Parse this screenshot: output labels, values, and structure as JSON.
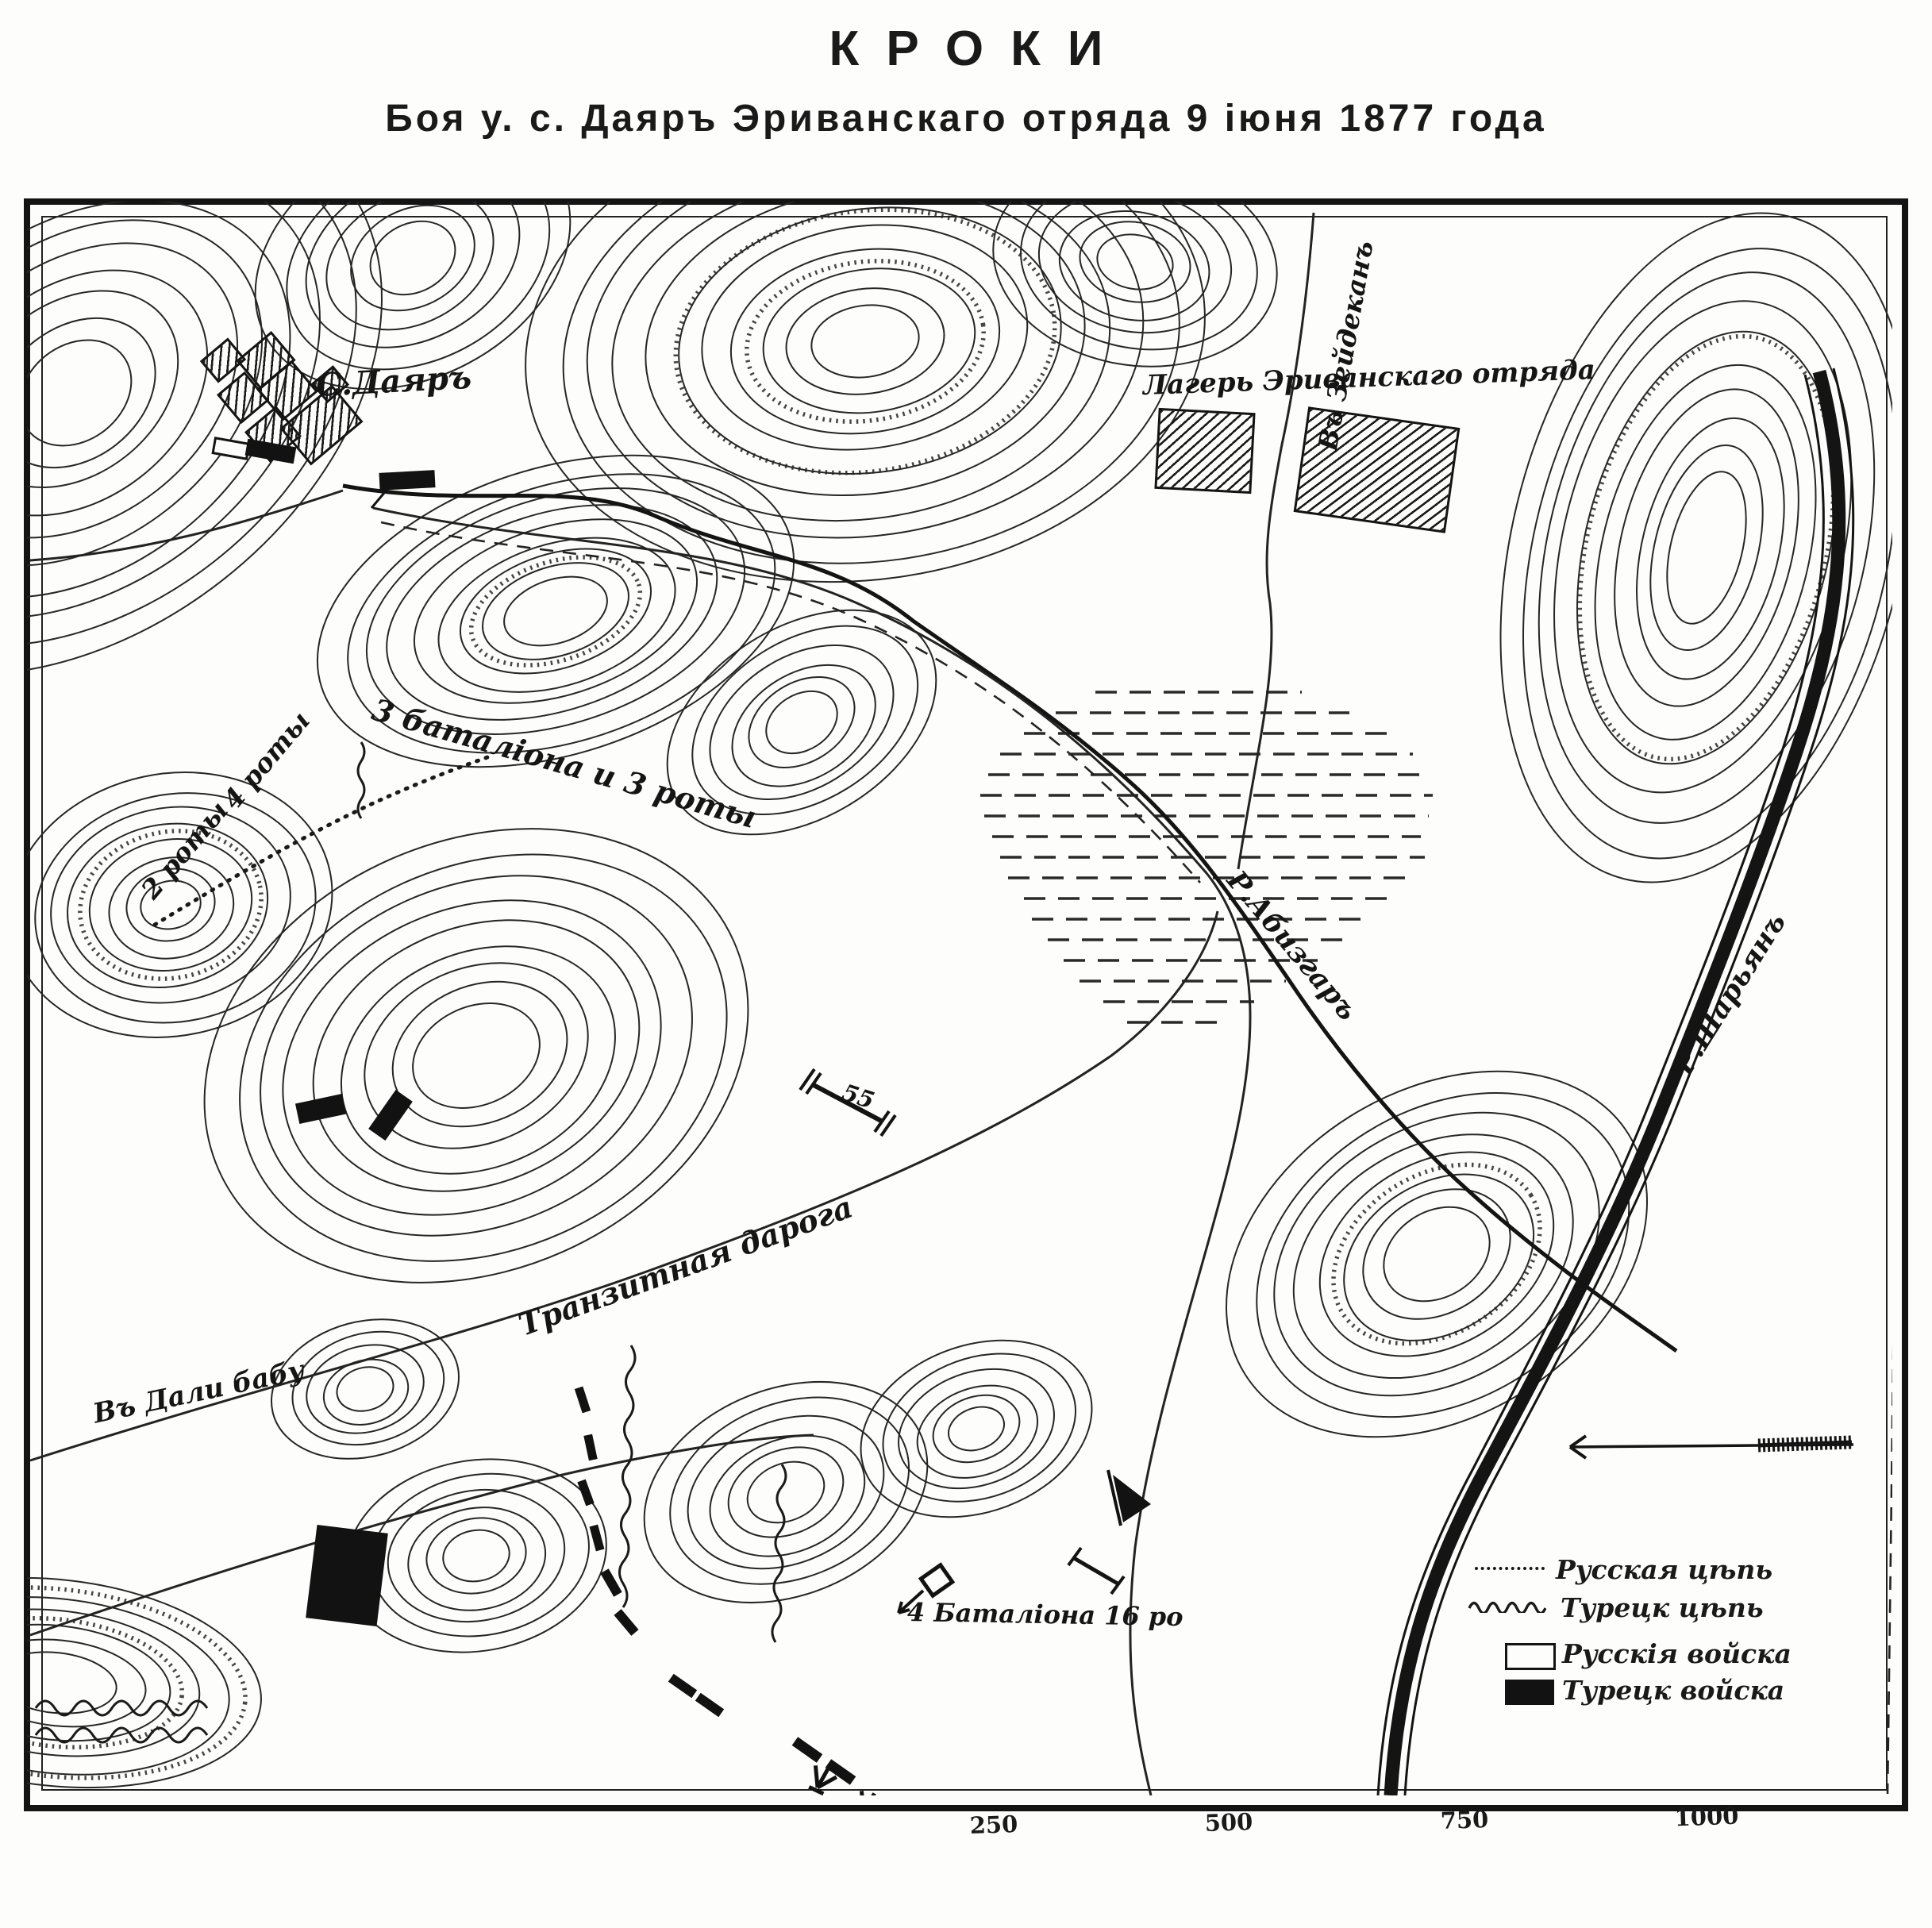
{
  "header": {
    "title": "КРОКИ",
    "subtitle": "Боя у. с. Даяръ Эриванскаго отряда 9 іюня 1877 года"
  },
  "map": {
    "labels": {
      "village": "С.Даяръ",
      "camp": "Лагерь Эриванскаго отряда",
      "to_zeydekan": "Въ Зейдеканъ",
      "three_battalions": "3 баталіона и 3 роты",
      "four_companies": "4 роты",
      "two_companies": "2 роты",
      "river_abizgar": "Р.Абизгаръ",
      "river_sharyan": "Р.Шарьянъ",
      "transit_road": "Транзитная дарога",
      "to_dali_babu": "Въ Дали бабу",
      "fourth_battalion": "4 Баталіона 16 ро",
      "height_mark": "55"
    },
    "legend": {
      "items": [
        {
          "symbol": "russian-chain-line",
          "label": "Русская цѣпь"
        },
        {
          "symbol": "turkish-chain-line",
          "label": "Турецк цѣпь"
        },
        {
          "symbol": "russian-troops-rect",
          "label": "Русскія войска"
        },
        {
          "symbol": "turkish-troops-rect",
          "label": "Турецк войска"
        }
      ]
    },
    "scale": {
      "ticks": [
        "250",
        "500",
        "750",
        "1000"
      ]
    }
  },
  "colors": {
    "ink": "#1a1a1a",
    "paper": "#fdfdfc"
  }
}
